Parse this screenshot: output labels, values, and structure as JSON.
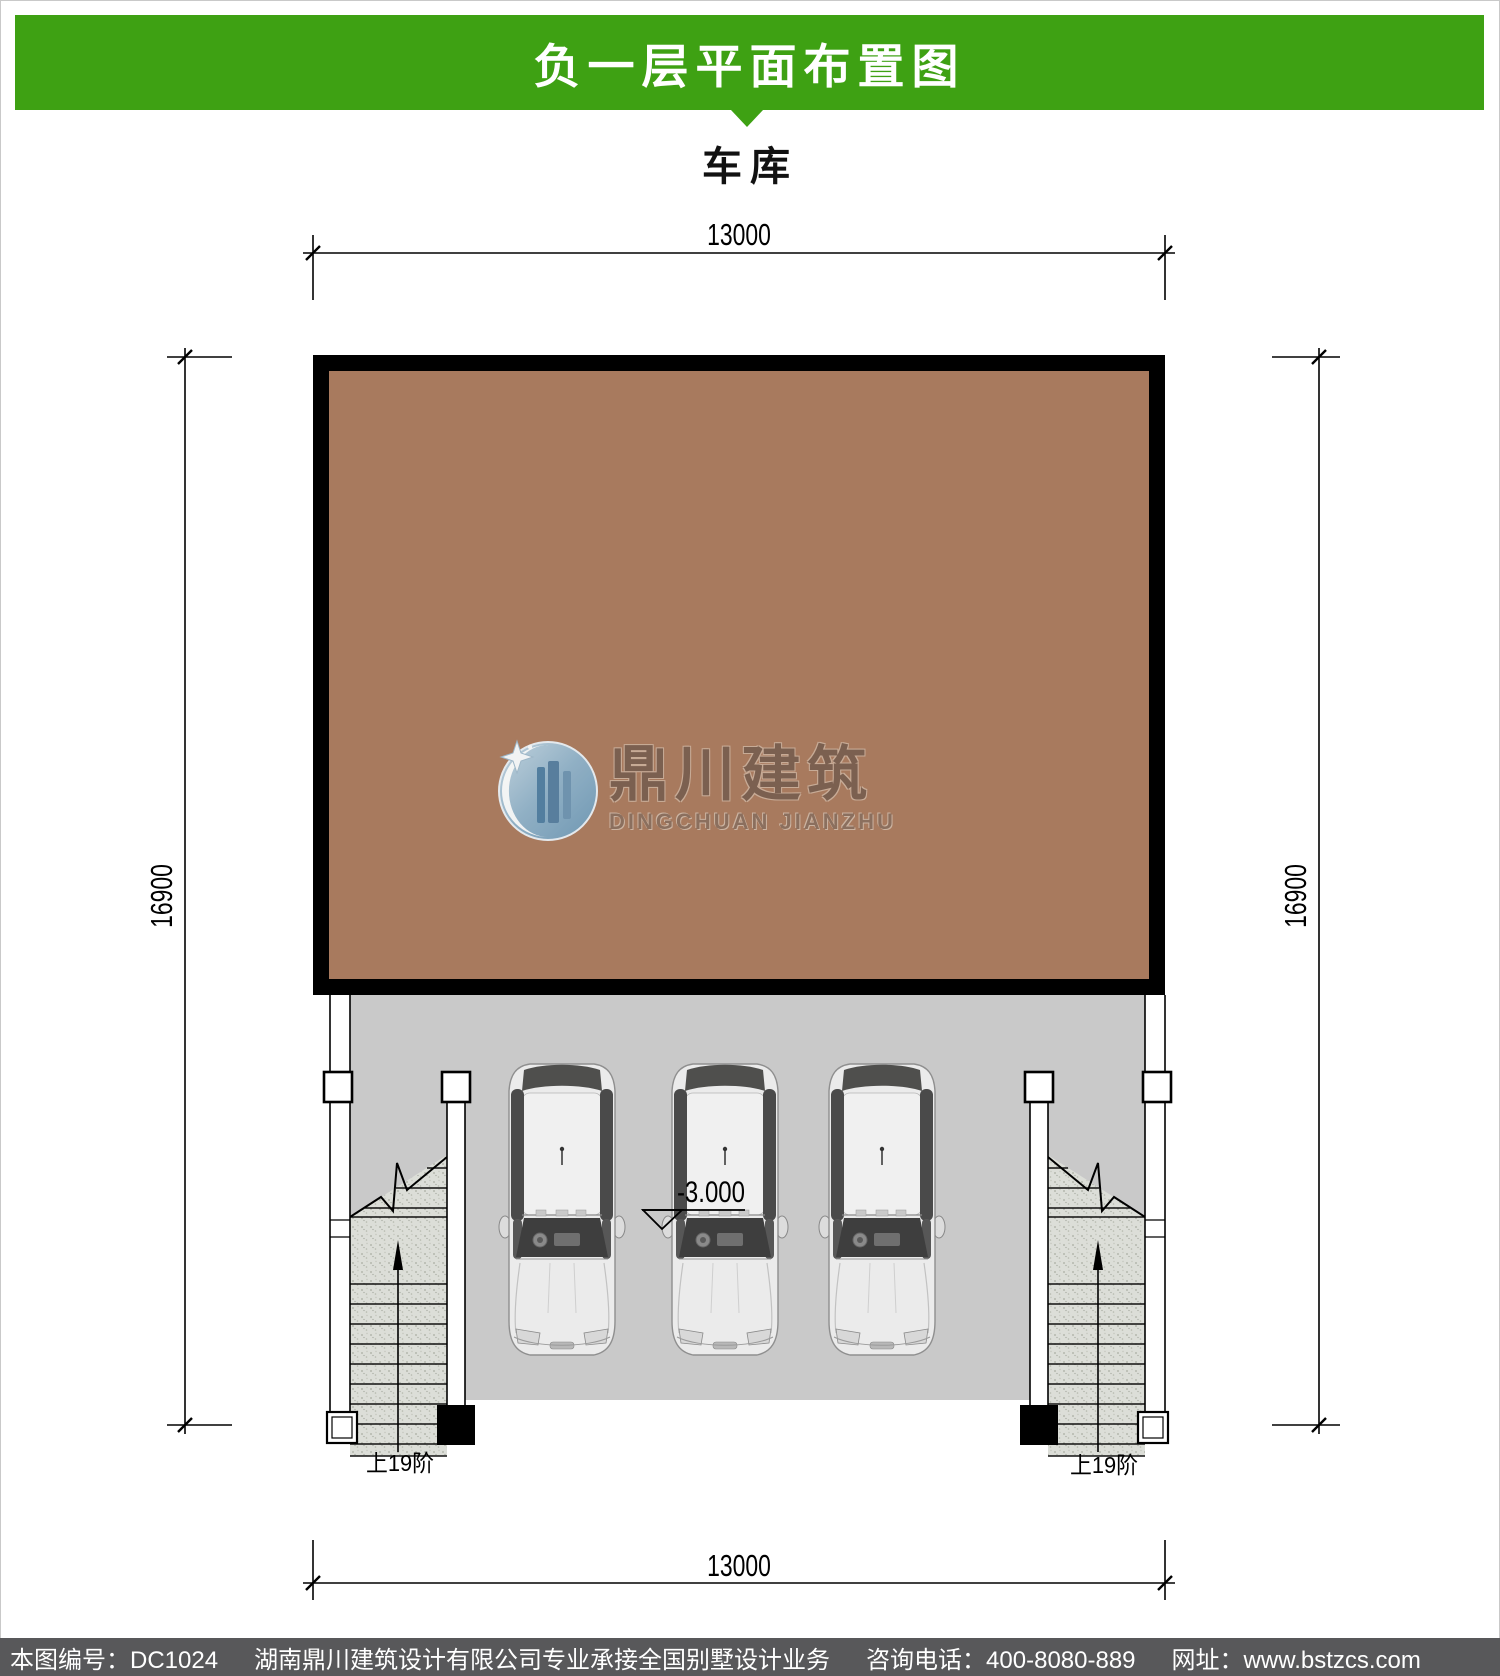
{
  "header": {
    "title": "负一层平面布置图"
  },
  "plan": {
    "room_label": "车库",
    "dims": {
      "top": "13000",
      "bottom": "13000",
      "left": "16900",
      "right": "16900"
    },
    "elevation": "-3.000",
    "stairs": {
      "left_label": "上19阶",
      "right_label": "上19阶"
    },
    "car_count": "3"
  },
  "watermark": {
    "cn": "鼎川建筑",
    "en": "DINGCHUAN JIANZHU"
  },
  "footer": {
    "drawing_no": "本图编号：DC1024",
    "company": "湖南鼎川建筑设计有限公司专业承接全国别墅设计业务",
    "phone": "咨询电话：400-8080-889",
    "website": "网址：www.bstzcs.com"
  },
  "colors": {
    "accent_green": "#3ea113",
    "room_brown": "#a87a5e",
    "floor_gray": "#c9c9c9",
    "footer_bar": "#58585a"
  }
}
